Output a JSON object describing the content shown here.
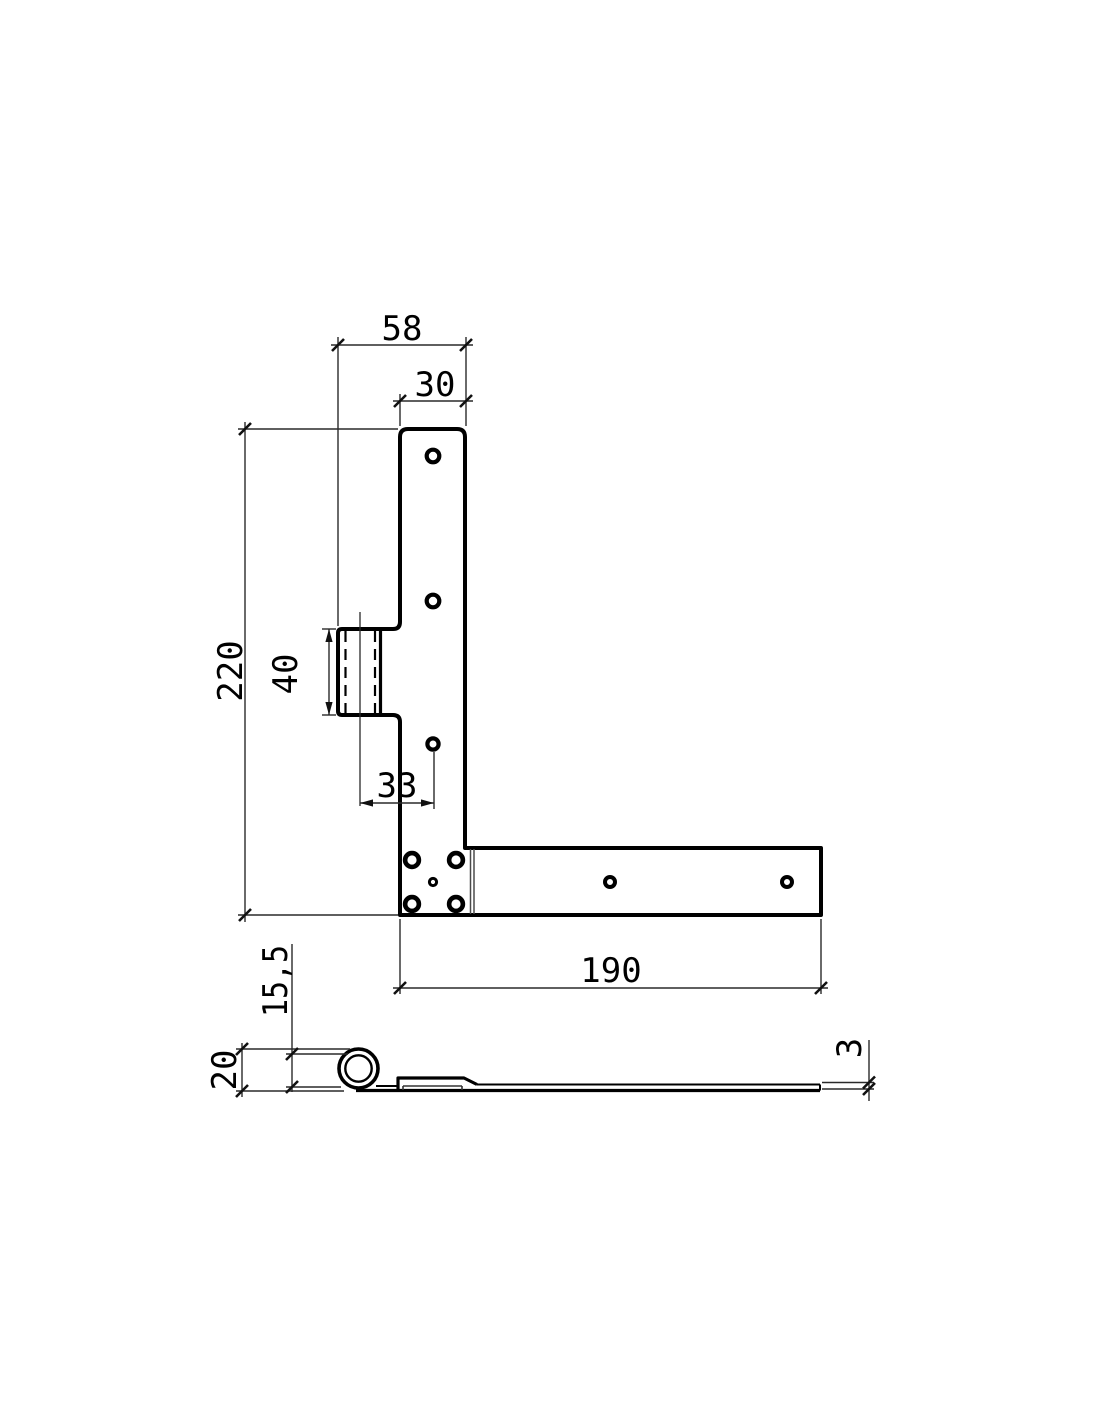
{
  "top_view": {
    "width_total": "58",
    "width_plate": "30",
    "height_total": "220",
    "knuckle_length": "40",
    "hole_offset": "33",
    "strap_length": "190"
  },
  "side_view": {
    "overall_height": "20",
    "knuckle_height": "15,5",
    "material_thickness": "3"
  },
  "colors": {
    "line": "#000000",
    "background": "#ffffff"
  }
}
